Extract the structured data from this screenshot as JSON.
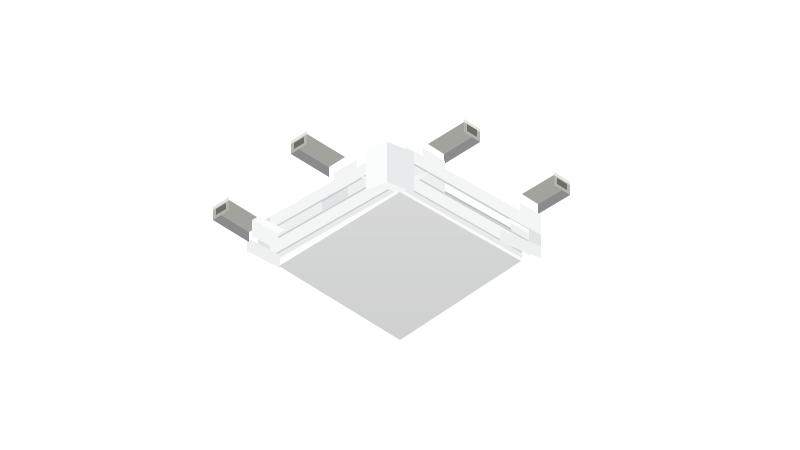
{
  "meta": {
    "background": "#ffffff",
    "description": "3D product render of a white square track-light corner connector viewed from below: a flat square base plate with stepped white flanges along its two upper sides and four silver metal contact tabs, two pointing upper-left and two pointing upper-right"
  },
  "colors": {
    "bg": "#ffffff",
    "plate_top": "#d7d8d8",
    "plate_bottom": "#cfd0d0",
    "white_bright": "#fbfcfc",
    "white_face": "#f4f5f5",
    "white_mid": "#eef0f0",
    "white_side": "#e8eaeb",
    "white_dim": "#e1e3e4",
    "seam": "#cdcfd0",
    "seam_dark": "#bcbebf",
    "metal_top": "#a3a39d",
    "metal_side": "#8b8b8d",
    "metal_end": "#b4b4ae",
    "metal_bright": "#e5e5e0",
    "metal_dark": "#6e6e69"
  }
}
